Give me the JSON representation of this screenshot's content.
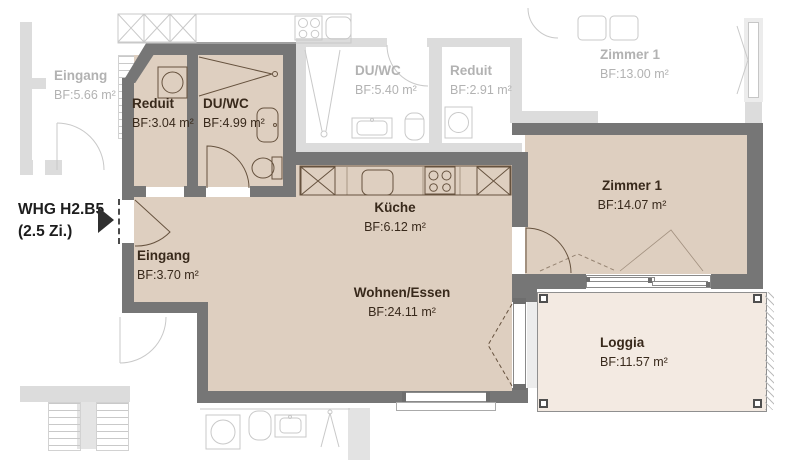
{
  "title_label": {
    "line1": "WHG H2.B5",
    "line2": "(2.5 Zi.)"
  },
  "rooms": {
    "reduit": {
      "name": "Reduit",
      "area": "BF:3.04 m²"
    },
    "duwc": {
      "name": "DU/WC",
      "area": "BF:4.99 m²"
    },
    "eingang": {
      "name": "Eingang",
      "area": "BF:3.70 m²"
    },
    "kueche": {
      "name": "Küche",
      "area": "BF:6.12 m²"
    },
    "wohnen": {
      "name": "Wohnen/Essen",
      "area": "BF:24.11 m²"
    },
    "zimmer1": {
      "name": "Zimmer 1",
      "area": "BF:14.07 m²"
    },
    "loggia": {
      "name": "Loggia",
      "area": "BF:11.57 m²"
    }
  },
  "neighbor_rooms": {
    "eingang": {
      "name": "Eingang",
      "area": "BF:5.66 m²"
    },
    "duwc": {
      "name": "DU/WC",
      "area": "BF:5.40 m²"
    },
    "reduit": {
      "name": "Reduit",
      "area": "BF:2.91 m²"
    },
    "zimmer1": {
      "name": "Zimmer 1",
      "area": "BF:13.00 m²"
    }
  },
  "colors": {
    "wall": "#767676",
    "room_fill": "#decfc0",
    "loggia_fill": "#f3eae2",
    "neighbor_wall": "#dcdcdc",
    "neighbor_line": "#c9c9c9",
    "main_line": "#66523e",
    "label": "#38291b",
    "neighbor_label": "#b2b2b2",
    "annotation": "#1d1d1d"
  }
}
